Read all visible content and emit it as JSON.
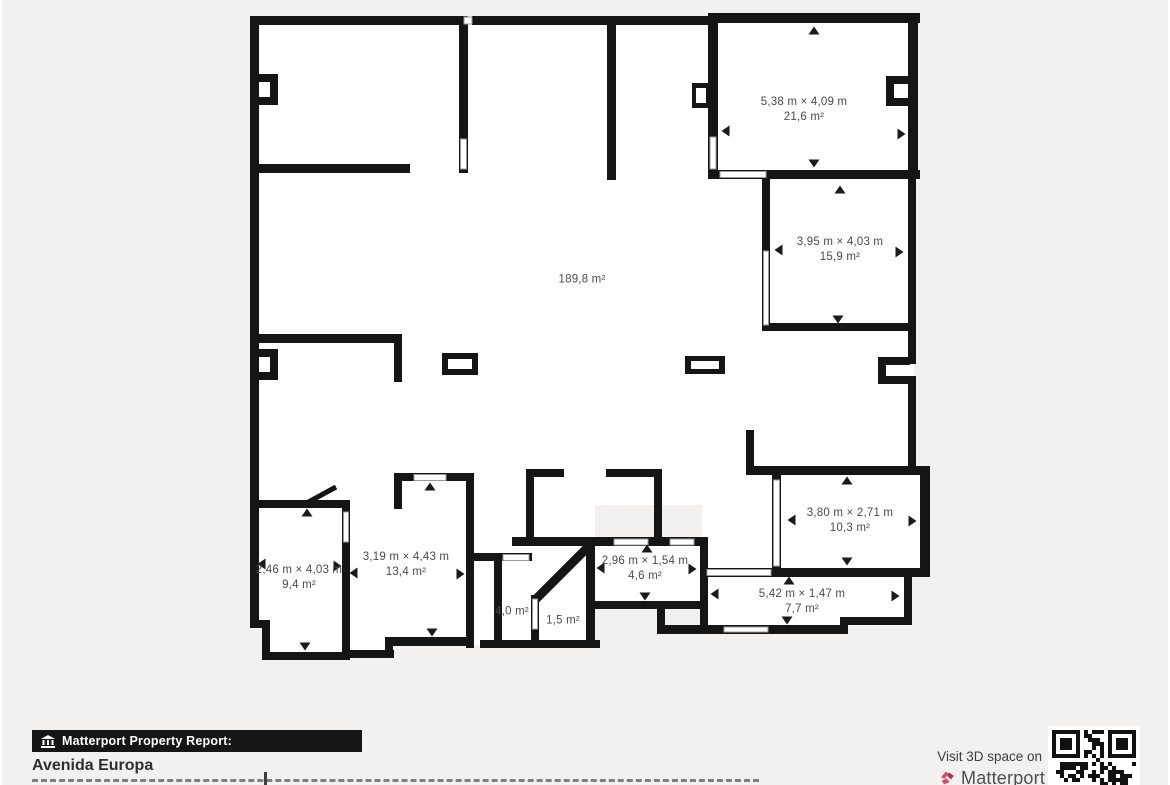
{
  "floor_plan": {
    "rooms": [
      {
        "dims": "5,38 m × 4,09 m",
        "area": "21,6 m²"
      },
      {
        "dims": "3,95 m × 4,03 m",
        "area": "15,9 m²"
      },
      {
        "dims": "",
        "area": "189,8 m²"
      },
      {
        "dims": "3,80 m × 2,71 m",
        "area": "10,3 m²"
      },
      {
        "dims": "2,96 m × 1,54 m",
        "area": "4,6 m²"
      },
      {
        "dims": "5,42 m × 1,47 m",
        "area": "7,7 m²"
      },
      {
        "dims": "2,46 m × 4,03 m",
        "area": "9,4 m²"
      },
      {
        "dims": "3,19 m × 4,43 m",
        "area": "13,4 m²"
      },
      {
        "dims": "",
        "area": "4,0 m²"
      },
      {
        "dims": "",
        "area": "1,5 m²"
      }
    ]
  },
  "footer": {
    "report_label": "Matterport Property Report:",
    "property_name": "Avenida Europa",
    "visit_text": "Visit 3D space on",
    "brand_name": "Matterport"
  },
  "colors": {
    "wall": "#151515",
    "background": "#f2f1ef",
    "matterport_red": "#dd4a5e",
    "label_text": "#4b4b4b"
  }
}
